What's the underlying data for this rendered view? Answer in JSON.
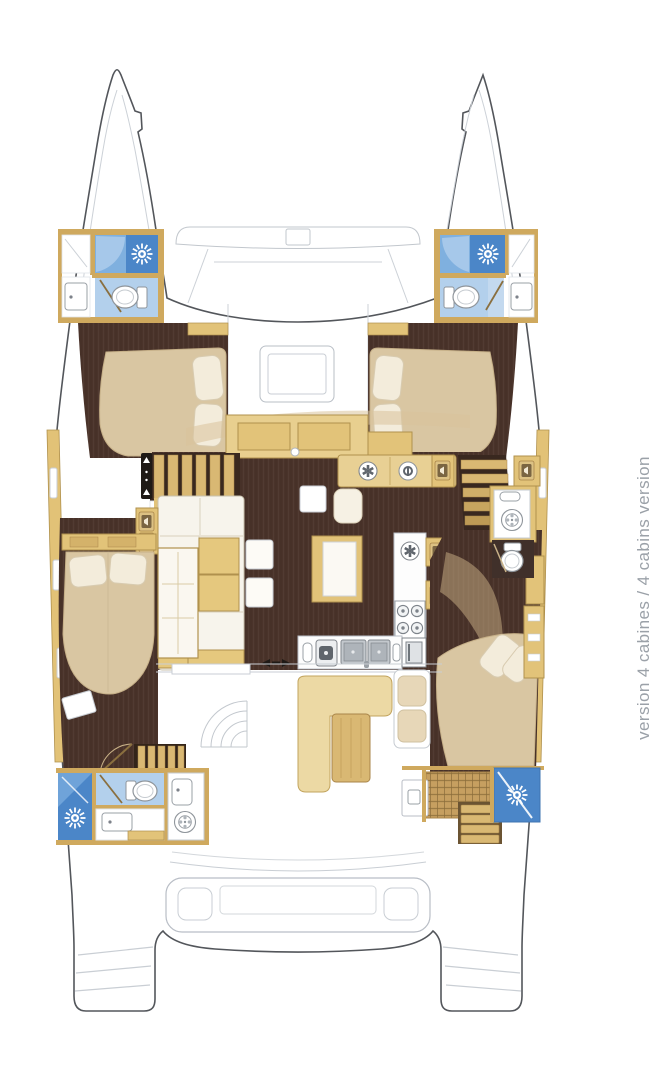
{
  "title": "catamaran deck plan - 4 cabins layout",
  "caption": {
    "text": "version 4 cabines / 4 cabins version",
    "color": "#9ba1a8",
    "rotation_deg": -90
  },
  "colors": {
    "background": "#ffffff",
    "hull_outline": "#53565b",
    "deck_detail_line": "#c9ced4",
    "wood_light": "#ecd9a4",
    "wood_mid": "#e2c379",
    "wood_dark": "#d9b873",
    "wood_border": "#b0914d",
    "floor_dark_brown": "#4a332a",
    "bed_beige": "#d9c6a2",
    "pillow_cream": "#f3ecdb",
    "shower_blue_dark": "#4b86c8",
    "shower_blue_mid": "#7fb0df",
    "bathroom_blue_light": "#b3d0ec",
    "fixture_white": "#ffffff",
    "caption_gray": "#9ba1a8"
  },
  "icons": [
    {
      "name": "shower-head-icon",
      "glyph": "white sunburst on blue"
    },
    {
      "name": "toilet-icon",
      "glyph": "white oval bowl with tank"
    },
    {
      "name": "washing-machine-icon",
      "glyph": "circle with drum dots"
    },
    {
      "name": "extractor-fan-icon",
      "glyph": "segmented circle"
    },
    {
      "name": "stove-icon",
      "glyph": "four burner circles"
    },
    {
      "name": "sink-icon",
      "glyph": "basin with drain dot"
    },
    {
      "name": "speaker-locker-icon",
      "glyph": "speaker front panel"
    },
    {
      "name": "companionway-arrows-icon",
      "glyph": "up-down arrows"
    },
    {
      "name": "sliding-door-arrows-icon",
      "glyph": "left-right arrows"
    }
  ],
  "features_depicted": [
    "two hulls with pointed bows",
    "foredeck beam",
    "port forward bathroom with shower and toilet",
    "starboard forward bathroom with shower and toilet",
    "port forward cabin double bed",
    "starboard forward cabin double bed",
    "saloon with L-shaped sofa and tables",
    "galley with double sink, round sink and 4-burner stove",
    "companionway stairs to each hull",
    "port aft cabin double bed",
    "port aft bathroom with shower, toilet and washer",
    "starboard mid bathroom with toilet and washer",
    "starboard aft cabin double bed",
    "starboard aft shower and steps",
    "cockpit bench and table",
    "aft beam with davits",
    "transom steps on both hulls"
  ]
}
